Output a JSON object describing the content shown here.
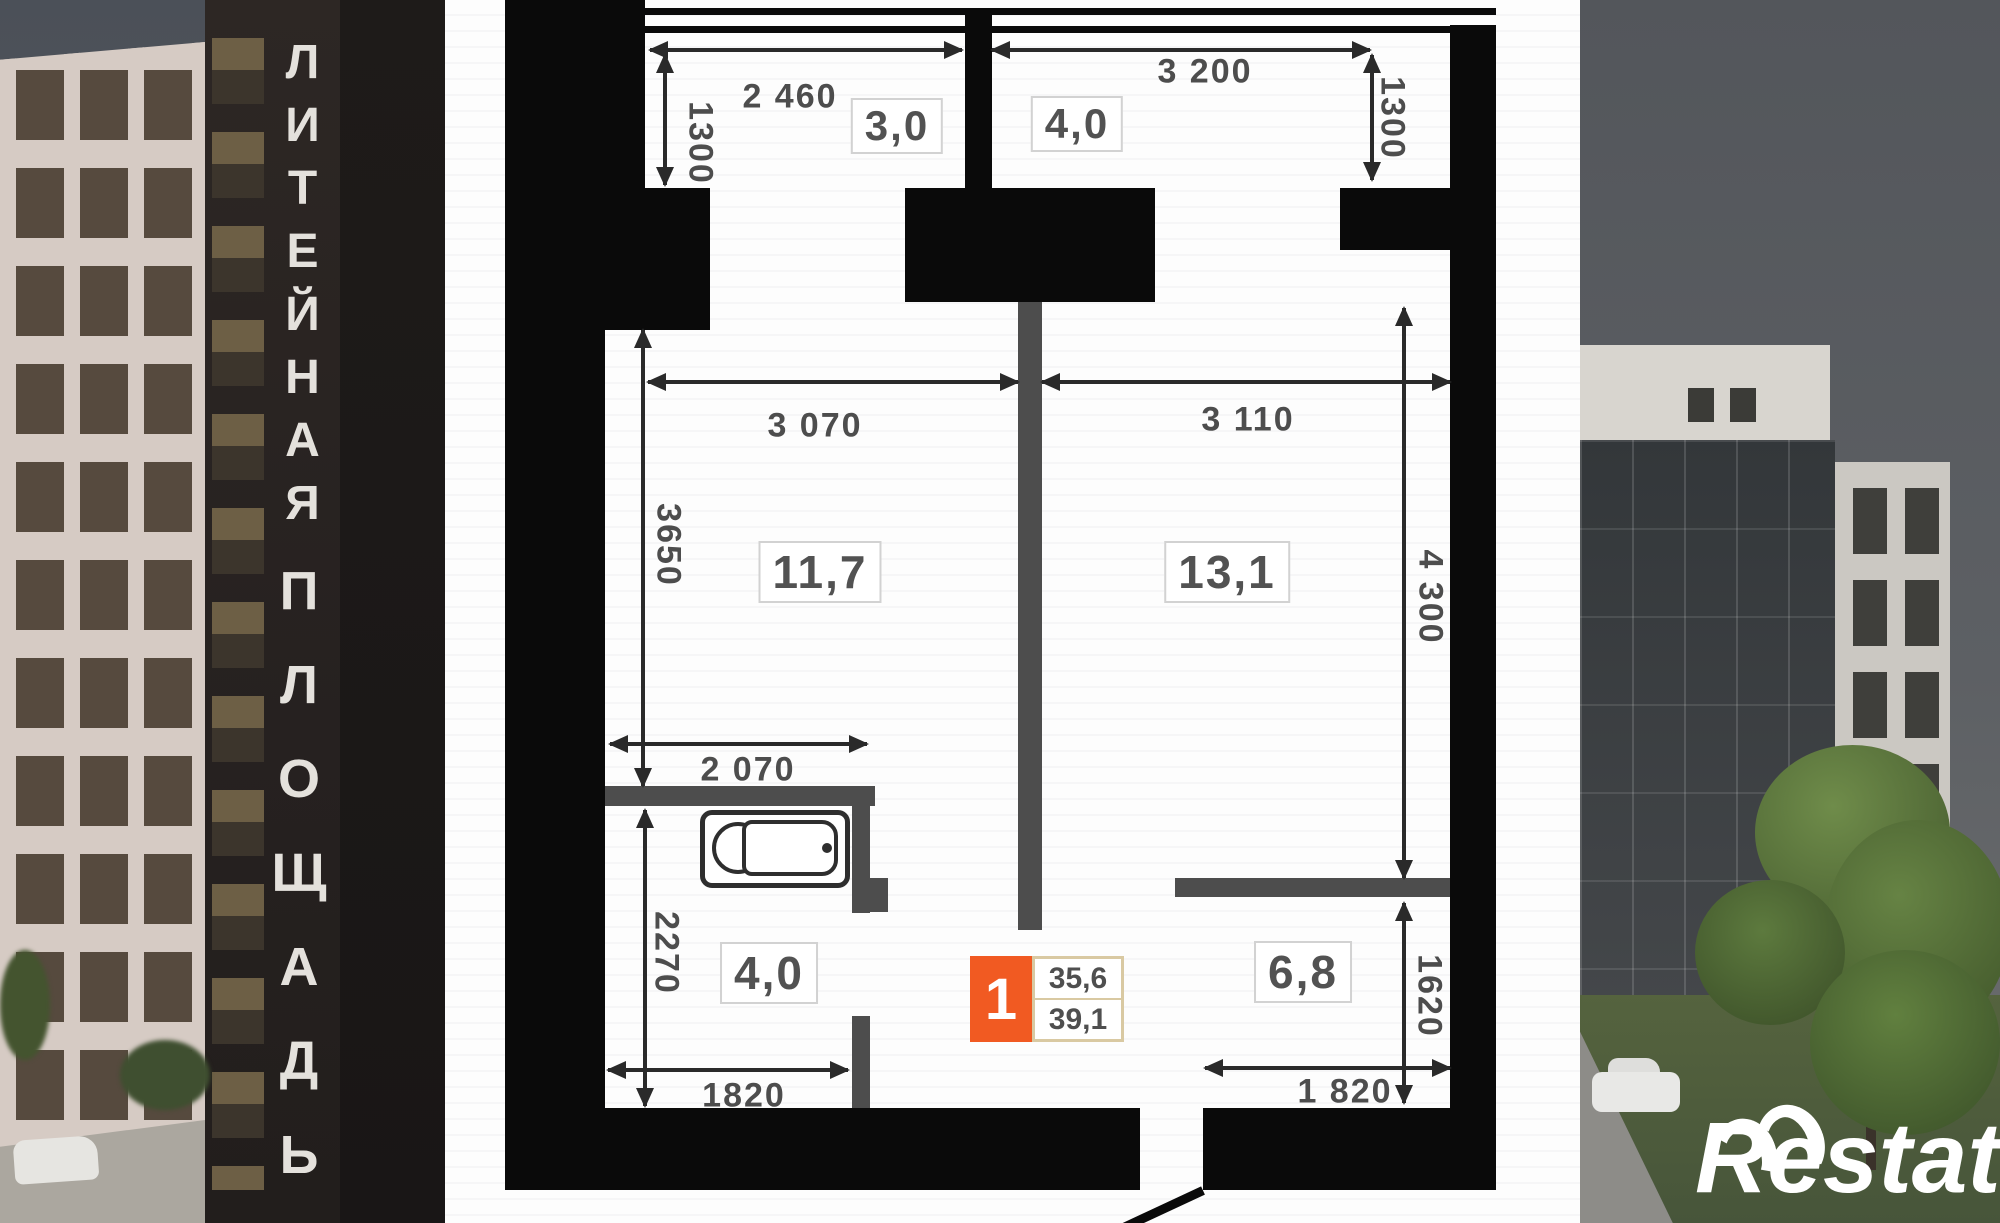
{
  "brand": {
    "logo_text": "Restate"
  },
  "left_building": {
    "sign_top": "ЛИТЕЙНАЯ",
    "sign_bottom": "ПЛОЩАДЬ"
  },
  "floorplan": {
    "unit_badge": {
      "number": "1",
      "area_top": "35,6",
      "area_bottom": "39,1"
    },
    "room_labels": {
      "balcony_left": "3,0",
      "balcony_right": "4,0",
      "living_left": "11,7",
      "living_right": "13,1",
      "hall": "4,0",
      "kitchen": "6,8"
    },
    "dimensions": {
      "d2460": "2 460",
      "d1300_left": "1300",
      "d3200": "3 200",
      "d1300_right": "1300",
      "d3070": "3 070",
      "d3110": "3 110",
      "d3650": "3650",
      "d4300": "4 300",
      "d2070": "2 070",
      "d2270": "2270",
      "d1820_left": "1820",
      "d1620": "1620",
      "d1820_right": "1 820"
    },
    "colors": {
      "accent_orange": "#f15a22",
      "badge_border": "#d9c9a2",
      "wall": "#0a0a0a"
    }
  }
}
